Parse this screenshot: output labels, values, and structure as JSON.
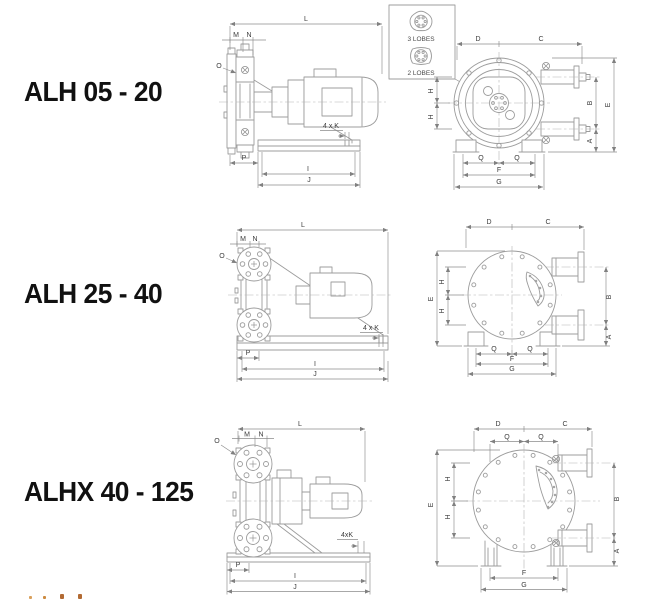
{
  "page": {
    "background": "#ffffff",
    "drawing_line_color": "#9c9c9c",
    "dimension_line_color": "#8b8b8b",
    "dimension_text_color": "#3c3c3c",
    "title_color": "#111111",
    "footer_artifact_colors": [
      "#d9a05c",
      "#cc8a3f",
      "#b26a33",
      "#b26a33"
    ]
  },
  "models": [
    {
      "title": "ALH 05 - 20"
    },
    {
      "title": "ALH 25 - 40"
    },
    {
      "title": "ALHX 40 - 125"
    }
  ],
  "detail_box": {
    "three_lobes_label": "3 LOBES",
    "two_lobes_label": "2 LOBES"
  },
  "dims": {
    "L": "L",
    "M": "M",
    "N": "N",
    "O": "O",
    "P": "P",
    "I": "I",
    "J": "J",
    "D": "D",
    "C": "C",
    "Q": "Q",
    "F": "F",
    "G": "G",
    "A": "A",
    "B": "B",
    "E": "E",
    "H": "H",
    "K4_spaced": "4 x K",
    "K4_compact": "4xK"
  }
}
